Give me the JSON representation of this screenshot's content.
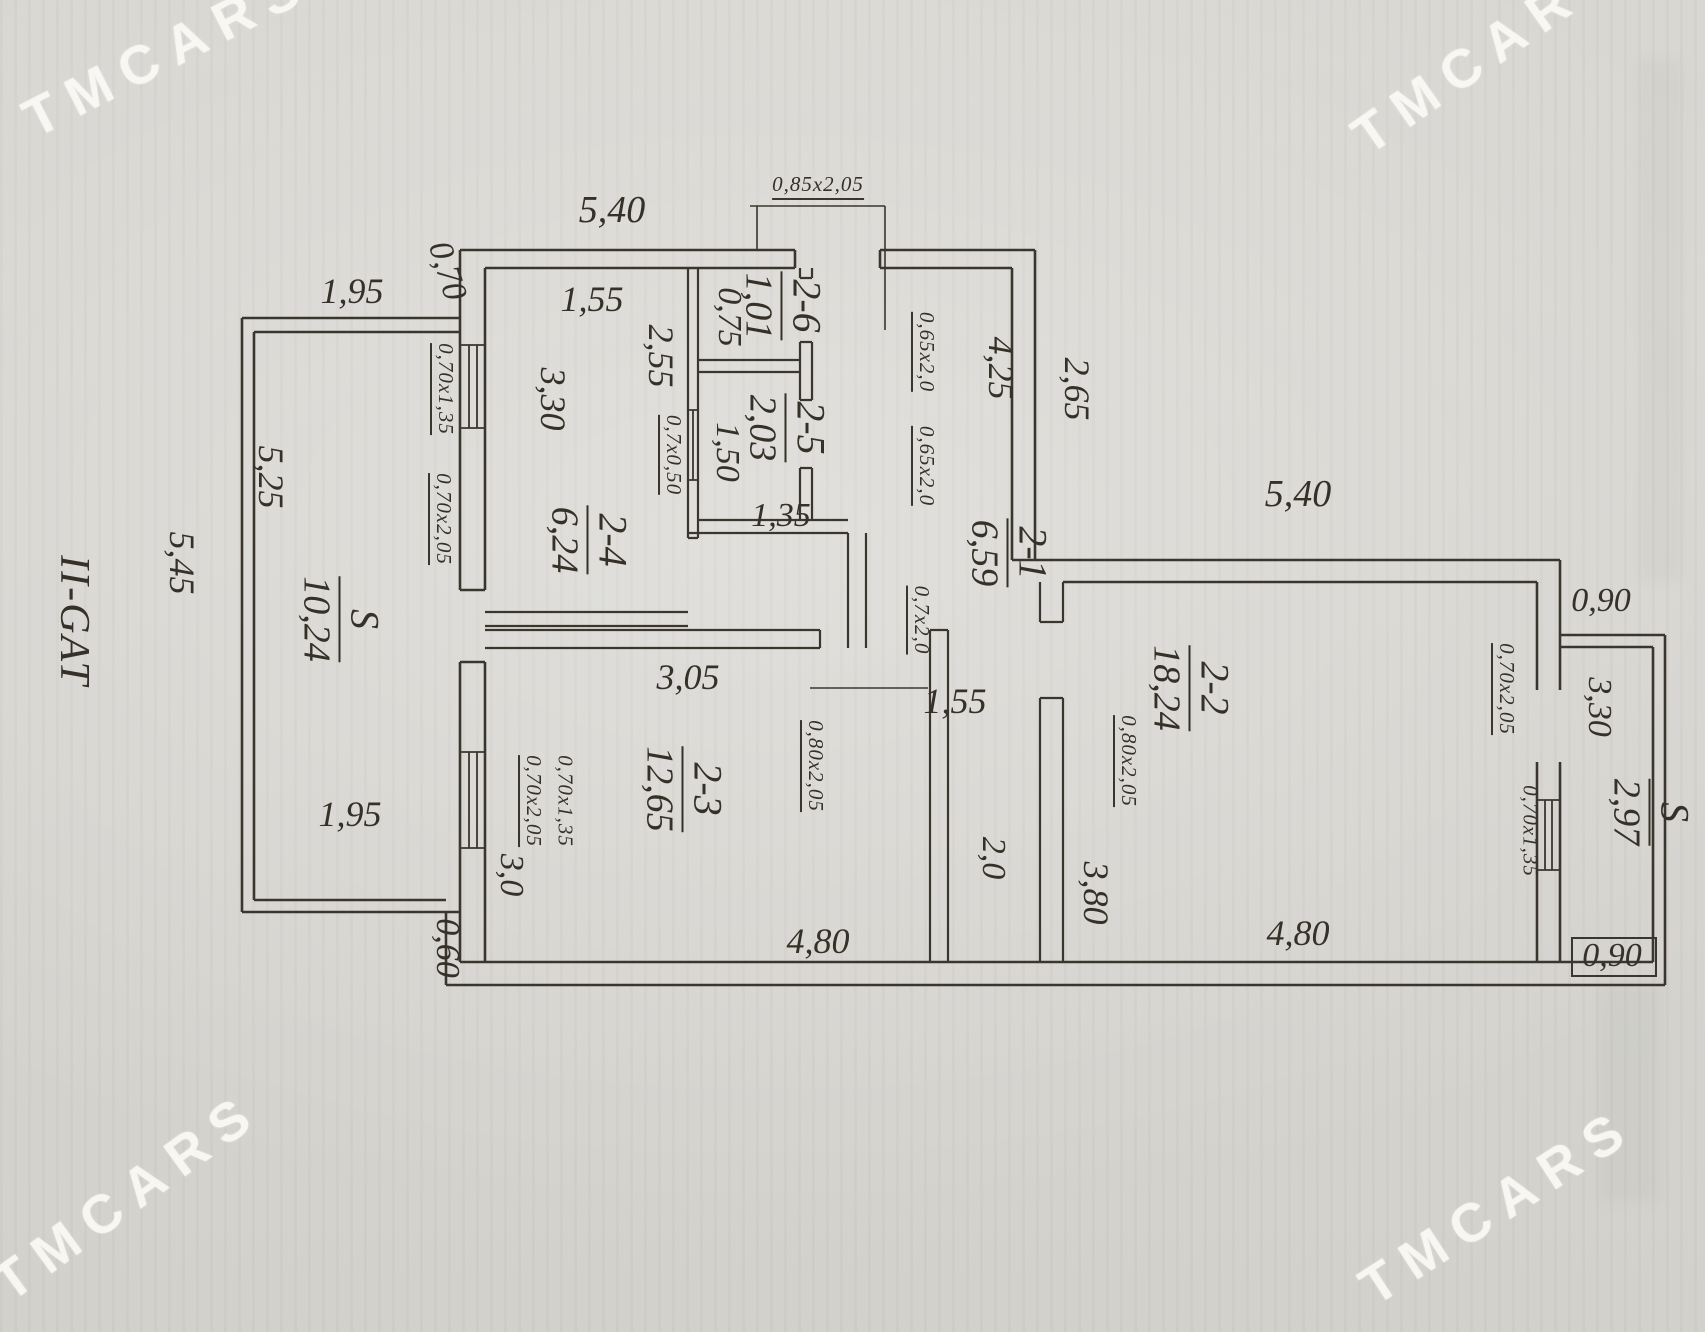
{
  "watermark": {
    "text": "TMCARS"
  },
  "palette": {
    "paper": "#d7d4cf",
    "ink": "#353128",
    "watermark": "#f8f7f4"
  },
  "plan": {
    "floor_label": "II-GAT",
    "rooms": [
      {
        "num": "2-1",
        "area": "6,59"
      },
      {
        "num": "2-2",
        "area": "18,24"
      },
      {
        "num": "2-3",
        "area": "12,65"
      },
      {
        "num": "2-4",
        "area": "6,24"
      },
      {
        "num": "2-5",
        "area": "2,03"
      },
      {
        "num": "2-6",
        "area": "1,01"
      },
      {
        "num": "S",
        "area": "10,24"
      },
      {
        "num": "S",
        "area": "2,97"
      }
    ],
    "dimensions": {
      "top_width": "5,40",
      "offset_top": "0,70",
      "annex_top": "1,95",
      "annex_inner": "5,25",
      "annex_outer": "5,45",
      "annex_bottom": "1,95",
      "offset_bottom": "0,60",
      "r24_top": "1,55",
      "r24_width": "2,55",
      "r24_height": "3,30",
      "r26_width": "0,75",
      "r25_width": "1,50",
      "r25_bottom": "1,35",
      "hall_height": "4,25",
      "right_upper": "2,65",
      "corridor_width": "1,55",
      "corridor_length": "2,0",
      "r23_top": "3,05",
      "r23_left": "3,0",
      "r23_bottom": "4,80",
      "r22_top": "5,40",
      "r22_left": "3,80",
      "r22_bottom": "4,80",
      "a2_top": "0,90",
      "a2_height": "3,30",
      "a2_bottom": "0,90"
    },
    "openings": {
      "entry_door": "0,85x2,05",
      "left_window": "0,70x1,35",
      "left_door": "0,70x2,05",
      "r25_pass": "0,7x0,50",
      "door_26": "0,65x2,0",
      "door_25": "0,65x2,0",
      "hall_door": "0,7x2,0",
      "r23_door": "0,80x2,05",
      "r23_win_a": "0,70x2,05",
      "r23_win_b": "0,70x1,35",
      "r22_door": "0,80x2,05",
      "a2_door": "0,70x2,05",
      "a2_window": "0,70x1,35"
    }
  }
}
